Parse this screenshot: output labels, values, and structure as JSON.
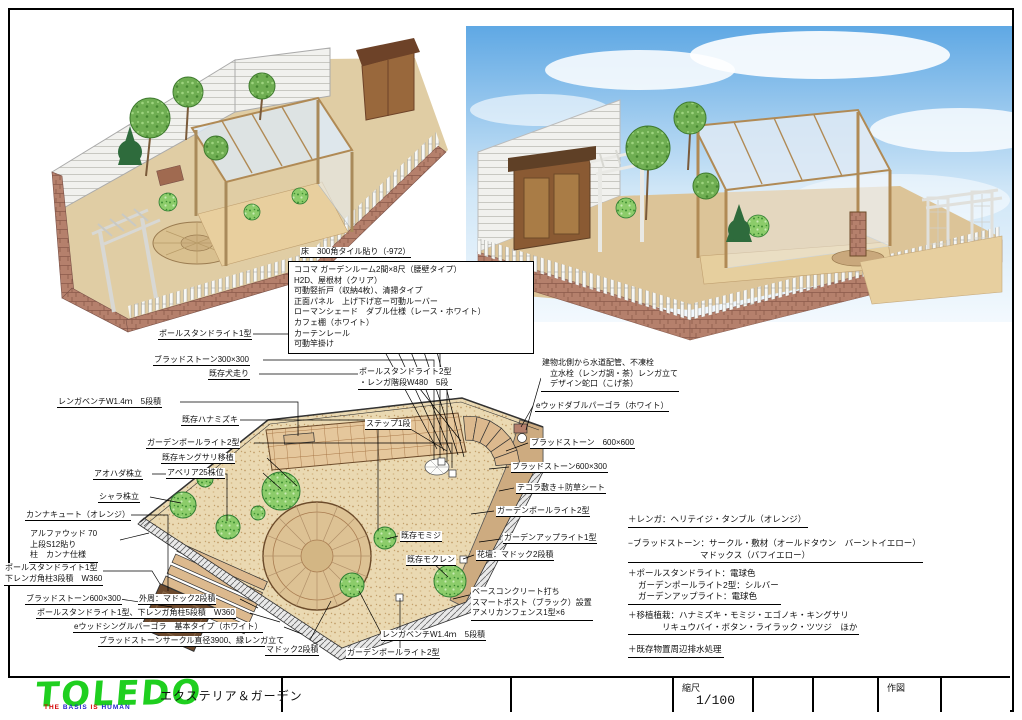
{
  "colors": {
    "sky_top": "#5fa8e4",
    "sky_bottom": "#f3f9fe",
    "brick": "#b5806c",
    "sand": "#ead9b2",
    "tile": "#e5c79c",
    "shrub_green": "#8ccc6a",
    "logo_green": "#1fcf1f",
    "tag_red": "#d40000",
    "tag_blue": "#2222cc"
  },
  "floor_label": "床　300角タイル貼り（-972）",
  "note_box": {
    "lines": [
      "ココマ ガーデンルーム2間×8尺（腰壁タイプ）",
      "H2D、屋根材（クリア）",
      "可動竪折戸（収納4枚）、清掃タイプ",
      "正面パネル　上げ下げ窓ー可動ルーバー",
      "ローマンシェード　ダブル仕様（レース・ホワイト）",
      "カフェ棚（ホワイト）",
      "カーテンレール",
      "可動竿掛け"
    ]
  },
  "labels": {
    "pole_stand_1a": "ポールスタンドライト1型",
    "bradstone_300": "ブラッドストーン300×300",
    "inubashiri": "既存犬走り",
    "bench_top": "レンガベンチW1.4ｍ　5段積",
    "hanamizuki": "既存ハナミズキ",
    "garden_pole_2a": "ガーデンポールライト2型",
    "kingusari": "既存キングサリ移植",
    "shrub25": "アベリア25株位",
    "aohada": "アオハダ株立",
    "shara": "シャラ株立",
    "kanna_cute": "カンナキュート（オレンジ）",
    "alpha_wood_1": "アルファウッド 70",
    "alpha_wood_2": "上段S12貼り",
    "alpha_wood_3": "柱　カンナ仕様",
    "pole_stand_1b_1": "ポールスタンドライト1型",
    "pole_stand_1b_2": "下レンガ角柱3段積　W360",
    "bradstone_600x300a": "ブラッドストーン600×300",
    "madoc_outer": "外周：マドック2段積",
    "pole_stand_5dan": "ポールスタンドライト1型、下レンガ角柱5段積　W360",
    "single_pergola": "eウッドシングルパーゴラ　基本タイプ（ホワイト）",
    "circle_3900": "ブラッドストーンサークル直径3900、縁レンガ立て",
    "madoc_2dan": "マドック2段積",
    "bench_bottom": "レンガベンチW1.4ｍ　5段積",
    "garden_pole_2b": "ガーデンポールライト2型",
    "step1": "ステップ1段",
    "momiji": "既存モミジ",
    "mokuren": "既存モクレン",
    "pole_stand_2_1": "ポールスタンドライト2型",
    "pole_stand_2_2": "・レンガ階段W480　5段",
    "water_1": "建物北側から水道配管、不凍栓",
    "water_2": "立水栓（レンガ調・茶）レンガ立て",
    "water_3": "デザイン蛇口（こげ茶）",
    "double_pergola": "eウッドダブルパーゴラ（ホワイト）",
    "bradstone_600x600": "ブラッドストーン　600×600",
    "bradstone_600x300b": "ブラッドストーン600×300",
    "tecora": "テコラ敷き＋防草シート",
    "garden_pole_2c": "ガーデンポールライト2型",
    "up_light": "ガーデンアップライト1型",
    "kadan_madoc": "花壇：マドック2段積",
    "fence_1": "ベースコンクリート打ち",
    "fence_2": "スマートポスト（ブラック）設置",
    "fence_3": "アメリカンフェンス1型×6"
  },
  "notes": {
    "n1": "＋レンガ：ヘリテイジ・タンブル（オレンジ）",
    "n2a": "−ブラッドストーン：サークル・敷材（オールドタウン　バーントイエロー）",
    "n2b": "マドックス（バフイエロー）",
    "n3a": "＋ポールスタンドライト：電球色",
    "n3b": "ガーデンポールライト2型：シルバー",
    "n3c": "ガーデンアップライト：電球色",
    "n4a": "＋移植植栽：ハナミズキ・モミジ・エゴノキ・キングサリ",
    "n4b": "リキュウバイ・ボタン・ライラック・ツツジ　ほか",
    "n5": "＋既存物置周辺排水処理"
  },
  "titleblock": {
    "logo": "TOLEDO",
    "tagline_words": [
      "THE",
      "BASIS",
      "IS",
      "HUMAN"
    ],
    "subtitle": "エクステリア＆ガーデン",
    "scale_label": "縮尺",
    "scale_value": "1/100",
    "drawn_label": "作図"
  }
}
